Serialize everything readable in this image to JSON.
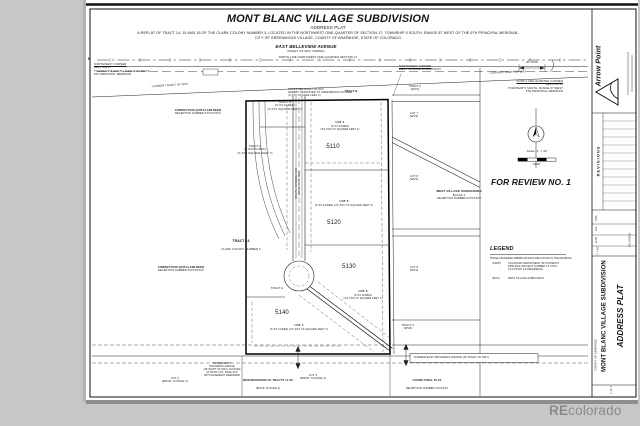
{
  "header": {
    "title": "MONT BLANC VILLAGE SUBDIVISION",
    "subtitle": "ADDRESS PLAT",
    "replat1": "A REPLAT OF TRACT 14, 15 AND 16 OF THE CLARK COLONY NUMBER 3, LOCATED IN THE NORTHWEST ONE-QUARTER OF SECTION 17, TOWNSHIP 5 SOUTH, RANGE 67 WEST OF THE 6TH PRINCIPAL MERIDIAN,",
    "replat2": "CITY OF GREENWOOD VILLAGE, COUNTY OF ARAPAHOE, STATE OF COLORADO"
  },
  "belleview": {
    "name": "EAST BELLEVIEW AVENUE",
    "row": "(RIGHT OF WAY VARIES)"
  },
  "street": {
    "name": "SOUTH JASMINE WAY",
    "row": "(50' RIGHT OF WAY)"
  },
  "notes": {
    "north_mark": "N",
    "nw_corner_title": "NORTHWEST CORNER",
    "nw_corner_body": "SECTION 17\nTOWNSHIP 5 SOUTH, RANGE 67 WEST\n6TH PRINCIPAL MERIDIAN",
    "north_line": "NORTH LINE NORTHWEST ONE-QUARTER SECTION 17",
    "current_row_left": "CURRENT RIGHT OF WAY",
    "current_row_right": "CURRENT RIGHT OF WAY",
    "nw_corner_wvs_title": "NORTHWEST CORNER",
    "nw_corner_wvs_body": "WEST VILLAGE SUBDIVISION",
    "n_quarter_title": "NORTH ONE-QUARTER CORNER",
    "n_quarter_body": "SECTION 17\nTOWNSHIP 5 SOUTH, RANGE 67 WEST\n6TH PRINCIPAL MERIDIAN",
    "row_dim": "40' ROW",
    "proposed_row": "PROPOSED RIGHT OF WAY\nHEREBY DEDICATED TO GREENWOOD VILLAGE\n(X,XXX SQUARE FEET ±)",
    "tract_b_flag": "TRACT B",
    "correction_deed_top_title": "CORRECTION QUITCLAIM DEED",
    "correction_deed_top_sub": "RECEPTION NUMBER XXXXXXXXX",
    "correction_deed_left_title": "CORRECTION QUITCLAIM DEED",
    "correction_deed_left_sub": "RECEPTION NUMBER XXXXXXXXX",
    "tract14_title": "TRACT 14",
    "tract14_sub": "CLARK COLONY NUMBER 3",
    "former_progress_left": "FORMER EAST\nPROGRESS AVENUE\n(25' RIGHT OF WAY) VACATED\nAT BOOK XXX, PAGE XXX\nWITH EASEMENT RESERVED",
    "former_progress_right": "FORMER EAST PROGRESS AVENUE (25' RIGHT OF WAY)"
  },
  "parcel": {
    "tract_b": "TRACT B\n(X.XX ACRES)\n(X,XXX SQUARE FEET ±)",
    "tract_a": "TRACT A\n(X.XXX ACRES)\n(X,XXX SQUARE FEET ±)",
    "tract_a_small": "TRACT A",
    "lots": [
      {
        "label": "LOT 1",
        "detail": "(X.XX ACRES)\n(XX,XXX.XX SQUARE FEET ±)",
        "address": "5110"
      },
      {
        "label": "LOT 2",
        "detail": "(X.XX ACRES) (XX,XXX.XX SQUARE FEET ±)",
        "address": "5120"
      },
      {
        "label": "LOT 3",
        "detail": "(X.XX ACRES)\n(XX,XXX.XX SQUARE FEET ±)",
        "address": "5130"
      },
      {
        "label": "LOT 4",
        "detail": "(X.XX ACRES) (XX,XXX.XX SQUARE FEET ±)",
        "address": "5140"
      }
    ]
  },
  "wvs": {
    "title": "WEST VILLAGE SUBDIVISION",
    "block": "BLOCK 1",
    "reception": "RECEPTION NUMBER XXXXXXXX",
    "tract_a": "TRACT A\n(WVS)",
    "lot7": "LOT 7\n(WVS)",
    "lot8": "LOT 8\n(WVS)",
    "lot9": "LOT 9\n(WVS)",
    "tract_c": "TRACT C\n(WVS)"
  },
  "south": {
    "lot2": "LOT 2\n(BOOK 72 PAGE 2)",
    "resub_title": "RESUBDIVISION OF TRACTS 17-20",
    "resub_sub": "(BOOK 72 PAGE 2)",
    "lot3": "LOT 3\n(BOOK 72 PAGE 2)",
    "chung_title": "CHUNG FINAL PLAT",
    "chung_sub": "RECEPTION NUMBER XXXXXXX"
  },
  "review": {
    "text": "FOR REVIEW NO. 1"
  },
  "scale": {
    "label": "Scale: 1\" = 40'",
    "feet": "FEET"
  },
  "legend": {
    "title": "LEGEND",
    "note": "THESE STANDARD ABBREVIATIONS ARE FOUND IN THE DRAWING",
    "e1_abbr": "(CDOH)",
    "e1_def": "COLORADO DEPARTMENT OF HIGHWAYS\nROW MAP, PROJECT NUMBER XX-XXXX,\nAS A POINT OF REFERENCE",
    "e2_abbr": "(WVS)",
    "e2_def": "WEST VILLAGE SUBDIVISION"
  },
  "titleblock": {
    "firm": "Arrow Point",
    "revisions": "REVISIONS",
    "f1": "N/A",
    "f2": "UA",
    "f3": "JHD",
    "f4": "1\" = 40'",
    "project": "MONT BLANC VILLAGE SUBDIVISION",
    "sheet_title": "ADDRESS PLAT",
    "county": "COUNTY OF ARAPAHOE",
    "state": "COLORADO",
    "sheet_no": "1 of 1"
  },
  "watermark": {
    "re": "RE",
    "rest": "colorado"
  }
}
